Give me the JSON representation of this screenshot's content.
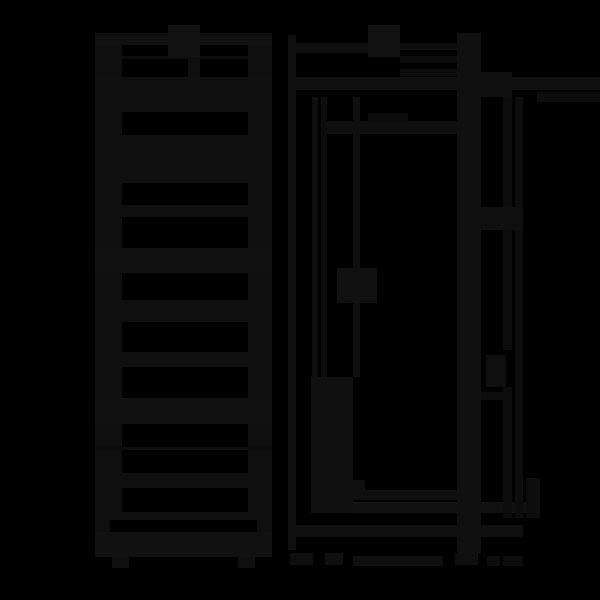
{
  "canvas": {
    "width": 600,
    "height": 600,
    "background": "#000000",
    "ink_default": "#0f0f0f",
    "ink_light": "#111111",
    "ink_thin": "#0d0d0d",
    "ink_label": "#121212"
  },
  "drawing": {
    "kind": "technical-drawing",
    "views": [
      {
        "name": "front-view-ladder-unit",
        "region": [
          95,
          25,
          272,
          568
        ]
      },
      {
        "name": "side-view-cabinet",
        "region": [
          288,
          25,
          478,
          568
        ]
      },
      {
        "name": "dimension-lines",
        "region": [
          481,
          33,
          600,
          568
        ]
      }
    ],
    "rects": [
      {
        "name": "front-left-rail",
        "x": 95,
        "y": 33,
        "w": 27,
        "h": 485,
        "c": "#0f0f0f"
      },
      {
        "name": "front-right-rail",
        "x": 248,
        "y": 33,
        "w": 24,
        "h": 485,
        "c": "#0f0f0f"
      },
      {
        "name": "front-top-bar",
        "x": 95,
        "y": 33,
        "w": 177,
        "h": 12,
        "c": "#111111"
      },
      {
        "name": "front-top-mid-slat",
        "x": 122,
        "y": 56,
        "w": 126,
        "h": 3,
        "c": "#0d0d0d"
      },
      {
        "name": "front-top-bar-2",
        "x": 95,
        "y": 77,
        "w": 177,
        "h": 35,
        "c": "#101010"
      },
      {
        "name": "front-label-block",
        "x": 168,
        "y": 25,
        "w": 32,
        "h": 32,
        "c": "#121212"
      },
      {
        "name": "front-label-stub",
        "x": 188,
        "y": 57,
        "w": 12,
        "h": 20,
        "c": "#0f0f0f"
      },
      {
        "name": "front-slab",
        "x": 95,
        "y": 135,
        "w": 177,
        "h": 48,
        "c": "#101010"
      },
      {
        "name": "front-slat-1",
        "x": 95,
        "y": 205,
        "w": 177,
        "h": 12,
        "c": "#0f0f0f"
      },
      {
        "name": "front-slat-2",
        "x": 95,
        "y": 248,
        "w": 177,
        "h": 25,
        "c": "#111111"
      },
      {
        "name": "front-slat-3",
        "x": 95,
        "y": 300,
        "w": 177,
        "h": 22,
        "c": "#0f0f0f"
      },
      {
        "name": "front-slat-4",
        "x": 95,
        "y": 352,
        "w": 177,
        "h": 15,
        "c": "#101010"
      },
      {
        "name": "front-slat-5",
        "x": 95,
        "y": 398,
        "w": 177,
        "h": 26,
        "c": "#111111"
      },
      {
        "name": "front-hairline",
        "x": 95,
        "y": 447,
        "w": 177,
        "h": 3,
        "c": "#0d0d0d"
      },
      {
        "name": "front-slat-6",
        "x": 95,
        "y": 473,
        "w": 177,
        "h": 15,
        "c": "#0f0f0f"
      },
      {
        "name": "front-bottom-bar",
        "x": 95,
        "y": 512,
        "w": 177,
        "h": 8,
        "c": "#0f0f0f"
      },
      {
        "name": "front-bottom-stub-left",
        "x": 95,
        "y": 520,
        "w": 15,
        "h": 12,
        "c": "#0f0f0f"
      },
      {
        "name": "front-bottom-stub-right",
        "x": 257,
        "y": 520,
        "w": 15,
        "h": 12,
        "c": "#0f0f0f"
      },
      {
        "name": "front-base",
        "x": 95,
        "y": 532,
        "w": 177,
        "h": 25,
        "c": "#111111"
      },
      {
        "name": "front-foot-left",
        "x": 112,
        "y": 557,
        "w": 17,
        "h": 11,
        "c": "#0f0f0f"
      },
      {
        "name": "front-foot-right",
        "x": 238,
        "y": 557,
        "w": 17,
        "h": 11,
        "c": "#0f0f0f"
      },
      {
        "name": "side-left-edge-line",
        "x": 288,
        "y": 35,
        "w": 8,
        "h": 515,
        "c": "#0f0f0f"
      },
      {
        "name": "side-top-line",
        "x": 296,
        "y": 43,
        "w": 104,
        "h": 10,
        "c": "#0f0f0f"
      },
      {
        "name": "side-top-line-b",
        "x": 400,
        "y": 43,
        "w": 78,
        "h": 7,
        "c": "#0d0d0d"
      },
      {
        "name": "side-top-line-c",
        "x": 400,
        "y": 56,
        "w": 78,
        "h": 7,
        "c": "#0d0d0d"
      },
      {
        "name": "side-top-line-d",
        "x": 400,
        "y": 69,
        "w": 78,
        "h": 7,
        "c": "#0d0d0d"
      },
      {
        "name": "side-top-long-line",
        "x": 288,
        "y": 77,
        "w": 312,
        "h": 13,
        "c": "#0f0f0f"
      },
      {
        "name": "side-top-right-line",
        "x": 537,
        "y": 92,
        "w": 63,
        "h": 10,
        "c": "#0d0d0d"
      },
      {
        "name": "side-label-block",
        "x": 368,
        "y": 25,
        "w": 32,
        "h": 32,
        "c": "#121212"
      },
      {
        "name": "side-label-stub",
        "x": 368,
        "y": 113,
        "w": 40,
        "h": 8,
        "c": "#0d0d0d"
      },
      {
        "name": "side-shelf-line",
        "x": 321,
        "y": 121,
        "w": 157,
        "h": 13,
        "c": "#0f0f0f"
      },
      {
        "name": "side-door-line-1",
        "x": 312,
        "y": 97,
        "w": 6,
        "h": 280,
        "c": "#0f0f0f"
      },
      {
        "name": "side-door-line-2",
        "x": 321,
        "y": 97,
        "w": 6,
        "h": 280,
        "c": "#0d0d0d"
      },
      {
        "name": "side-inner-line",
        "x": 353,
        "y": 97,
        "w": 7,
        "h": 280,
        "c": "#0f0f0f"
      },
      {
        "name": "side-door-handle",
        "x": 337,
        "y": 268,
        "w": 40,
        "h": 35,
        "c": "#111111"
      },
      {
        "name": "side-door-bottom-panel",
        "x": 311,
        "y": 377,
        "w": 42,
        "h": 136,
        "c": "#101010"
      },
      {
        "name": "side-bottom-step",
        "x": 353,
        "y": 480,
        "w": 12,
        "h": 10,
        "c": "#0f0f0f"
      },
      {
        "name": "side-bottom-line-1",
        "x": 353,
        "y": 490,
        "w": 105,
        "h": 10,
        "c": "#0f0f0f"
      },
      {
        "name": "side-bottom-line-2",
        "x": 353,
        "y": 502,
        "w": 185,
        "h": 11,
        "c": "#111111"
      },
      {
        "name": "side-bottom-line-3",
        "x": 295,
        "y": 525,
        "w": 228,
        "h": 12,
        "c": "#0f0f0f"
      },
      {
        "name": "side-back-band",
        "x": 457,
        "y": 33,
        "w": 24,
        "h": 520,
        "c": "#101010"
      },
      {
        "name": "dim-top-connector",
        "x": 481,
        "y": 72,
        "w": 31,
        "h": 25,
        "c": "#0f0f0f"
      },
      {
        "name": "dim-line-a-upper",
        "x": 503,
        "y": 97,
        "w": 9,
        "h": 253,
        "c": "#0d0d0d"
      },
      {
        "name": "dim-line-a-lower",
        "x": 503,
        "y": 387,
        "w": 9,
        "h": 131,
        "c": "#0d0d0d"
      },
      {
        "name": "dim-line-b",
        "x": 515,
        "y": 97,
        "w": 8,
        "h": 421,
        "c": "#0d0d0d"
      },
      {
        "name": "dim-crossbar",
        "x": 481,
        "y": 207,
        "w": 42,
        "h": 23,
        "c": "#0f0f0f"
      },
      {
        "name": "dim-arrow-blob",
        "x": 486,
        "y": 355,
        "w": 20,
        "h": 32,
        "c": "#0f0f0f"
      },
      {
        "name": "dim-bar",
        "x": 481,
        "y": 392,
        "w": 24,
        "h": 8,
        "c": "#0d0d0d"
      },
      {
        "name": "dim-line-c",
        "x": 526,
        "y": 478,
        "w": 14,
        "h": 40,
        "c": "#0d0d0d"
      },
      {
        "name": "side-foot-1",
        "x": 290,
        "y": 553,
        "w": 23,
        "h": 12,
        "c": "#0f0f0f"
      },
      {
        "name": "side-foot-2",
        "x": 325,
        "y": 553,
        "w": 18,
        "h": 12,
        "c": "#0f0f0f"
      },
      {
        "name": "side-foot-bar",
        "x": 353,
        "y": 556,
        "w": 90,
        "h": 10,
        "c": "#0f0f0f"
      },
      {
        "name": "side-foot-3",
        "x": 455,
        "y": 553,
        "w": 23,
        "h": 12,
        "c": "#0f0f0f"
      },
      {
        "name": "side-foot-4",
        "x": 487,
        "y": 556,
        "w": 13,
        "h": 10,
        "c": "#0d0d0d"
      },
      {
        "name": "side-foot-5",
        "x": 503,
        "y": 556,
        "w": 20,
        "h": 10,
        "c": "#0d0d0d"
      }
    ]
  }
}
